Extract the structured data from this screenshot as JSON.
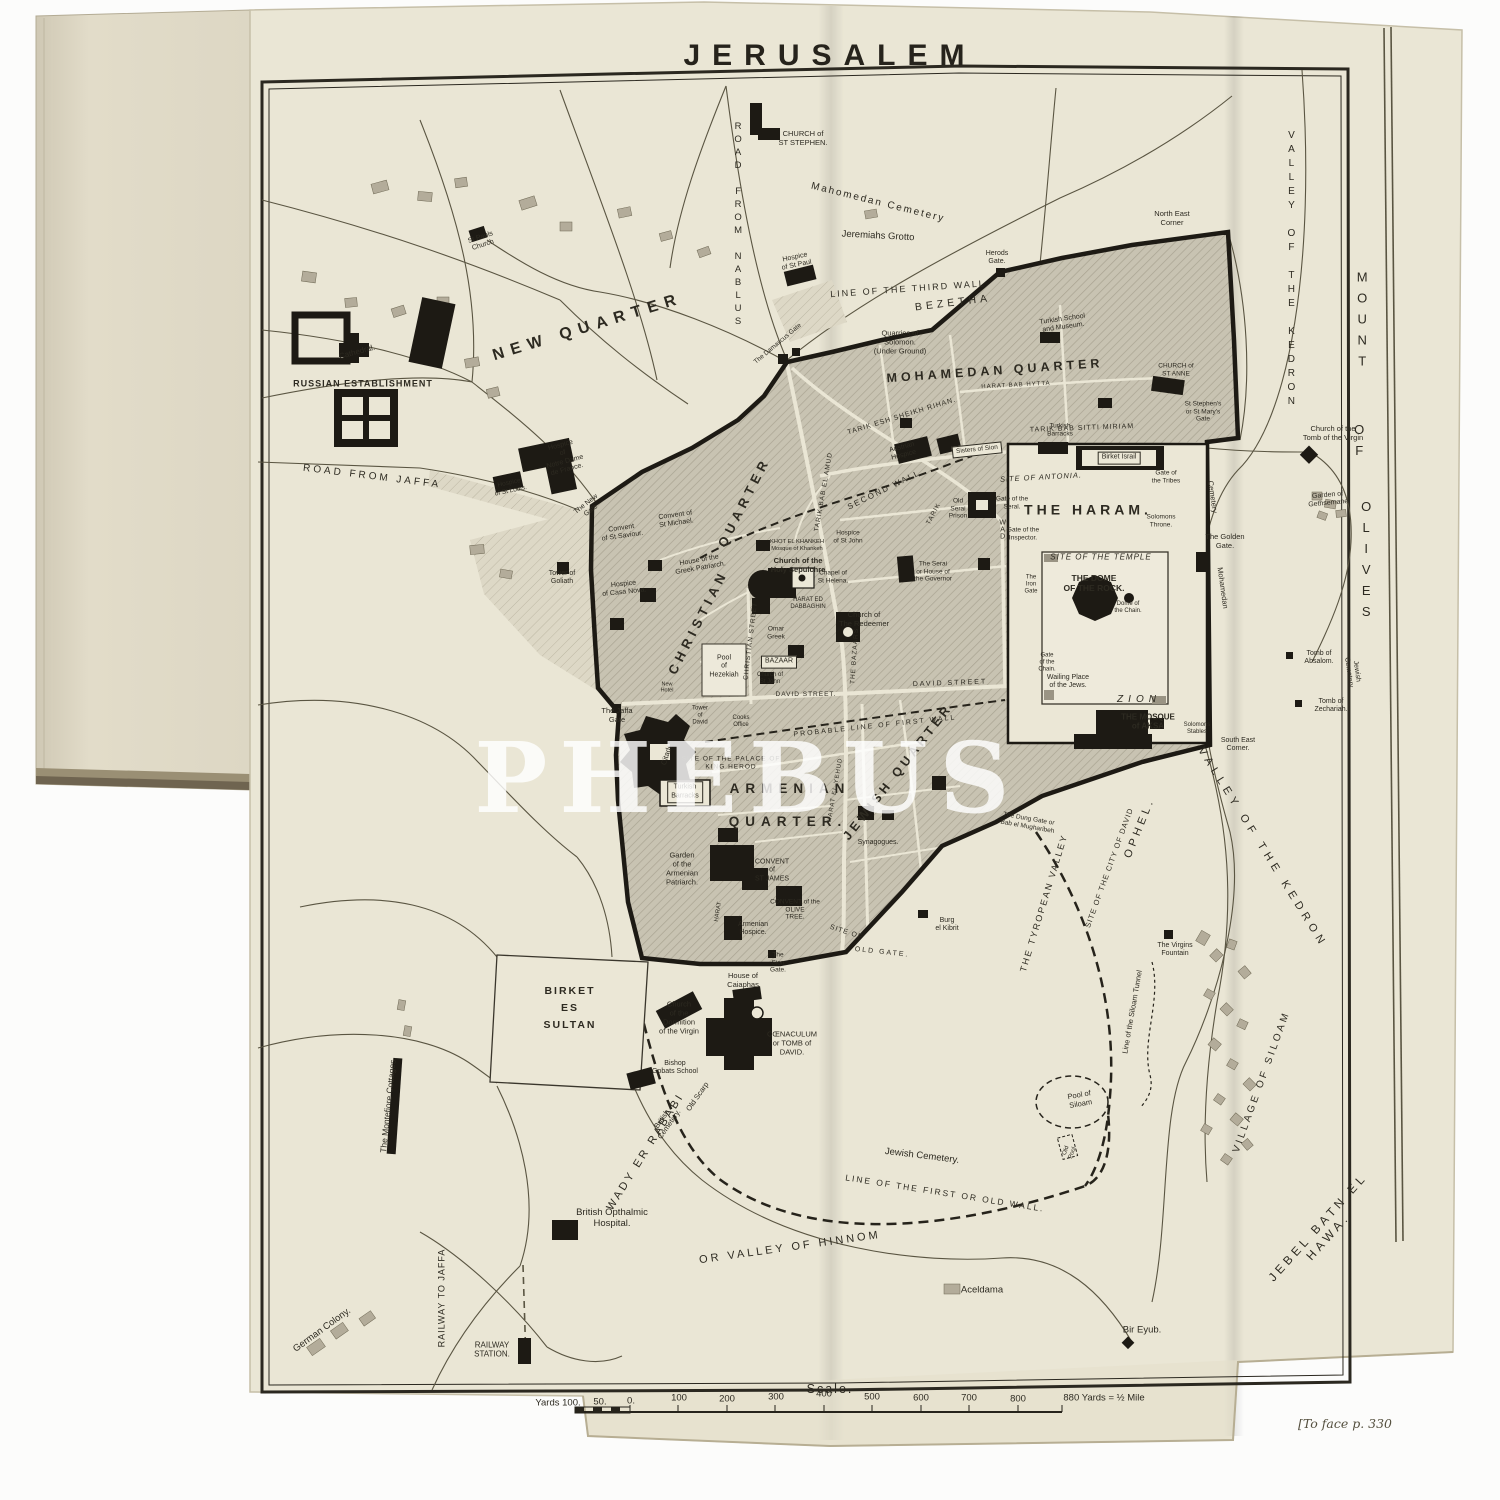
{
  "page": {
    "title": "JERUSALEM",
    "watermark": "PHEBUS",
    "caption": "[To face p. 330"
  },
  "scale": {
    "heading": "— Scale. —"
  },
  "labels": [
    {
      "t": "NEW QUARTER",
      "x": 588,
      "y": 328,
      "r": -17,
      "s": 16,
      "ls": 7,
      "c": "b"
    },
    {
      "t": "MOHAMEDAN QUARTER",
      "x": 995,
      "y": 371,
      "r": -4,
      "s": 12.5,
      "ls": 4,
      "c": "b"
    },
    {
      "t": "CHRISTIAN",
      "x": 698,
      "y": 622,
      "r": -63,
      "s": 13,
      "ls": 5,
      "c": "b"
    },
    {
      "t": "QUARTER",
      "x": 744,
      "y": 502,
      "r": -63,
      "s": 13,
      "ls": 5,
      "c": "b"
    },
    {
      "t": "ARMENIAN",
      "x": 790,
      "y": 789,
      "s": 13.5,
      "ls": 6,
      "c": "b"
    },
    {
      "t": "QUARTER.",
      "x": 788,
      "y": 822,
      "s": 13.5,
      "ls": 6,
      "c": "b"
    },
    {
      "t": "JEWISH QUARTER",
      "x": 898,
      "y": 772,
      "r": -52,
      "s": 12.5,
      "ls": 4,
      "c": "b"
    },
    {
      "t": "THE HARAM.",
      "x": 1088,
      "y": 510,
      "s": 14,
      "ls": 4,
      "c": "b"
    },
    {
      "t": "BEZETHA",
      "x": 953,
      "y": 303,
      "r": -7,
      "s": 10.5,
      "ls": 4
    },
    {
      "t": "ZION",
      "x": 1139,
      "y": 700,
      "s": 10,
      "ls": 5,
      "c": "i"
    },
    {
      "t": "RUSSIAN ESTABLISHMENT",
      "x": 363,
      "y": 384,
      "s": 9,
      "ls": 1,
      "c": "b"
    },
    {
      "t": "BIRKET\nES\nSULTAN",
      "x": 570,
      "y": 1008,
      "s": 10.5,
      "ls": 2,
      "c": "b lh"
    },
    {
      "t": "MOUNT",
      "x": 1362,
      "y": 322,
      "s": 13,
      "ls": 6,
      "c": "stack"
    },
    {
      "t": "OF",
      "x": 1359,
      "y": 443,
      "s": 13,
      "ls": 6,
      "c": "stack"
    },
    {
      "t": "OLIVES",
      "x": 1366,
      "y": 562,
      "s": 13,
      "ls": 6,
      "c": "stack"
    },
    {
      "t": "VALLEY OF THE KEDRON",
      "x": 1291,
      "y": 270,
      "s": 10,
      "ls": 3,
      "c": "stack"
    },
    {
      "t": "VALLEY OF THE KEDRON",
      "x": 1262,
      "y": 848,
      "r": 58,
      "s": 11,
      "ls": 5
    },
    {
      "t": "OPHEL.",
      "x": 1140,
      "y": 828,
      "r": -68,
      "s": 11,
      "ls": 4
    },
    {
      "t": "THE TYROPEAN VALLEY",
      "x": 1044,
      "y": 903,
      "r": -73,
      "s": 9,
      "ls": 2
    },
    {
      "t": "SITE OF THE CITY OF DAVID",
      "x": 1110,
      "y": 868,
      "r": -70,
      "s": 7.5,
      "ls": 1
    },
    {
      "t": "Line of the Siloam Tunnel",
      "x": 1133,
      "y": 1012,
      "r": -80,
      "s": 7.5
    },
    {
      "t": "VILLAGE OF SILOAM",
      "x": 1262,
      "y": 1082,
      "r": -70,
      "s": 10,
      "ls": 3
    },
    {
      "t": "JEBEL BATN EL HAWA.",
      "x": 1323,
      "y": 1232,
      "r": -48,
      "s": 12,
      "ls": 4
    },
    {
      "t": "WADY ER RABABI",
      "x": 646,
      "y": 1152,
      "r": -58,
      "s": 11,
      "ls": 3
    },
    {
      "t": "OR VALLEY OF HINNOM",
      "x": 790,
      "y": 1248,
      "r": -8,
      "s": 11,
      "ls": 3
    },
    {
      "t": "LINE OF THE FIRST OR OLD WALL.",
      "x": 945,
      "y": 1193,
      "r": 9,
      "s": 8.5,
      "ls": 2
    },
    {
      "t": "Jewish Cemetery.",
      "x": 922,
      "y": 1156,
      "r": 7,
      "s": 9.5
    },
    {
      "t": "Mahomedan Cemetery",
      "x": 878,
      "y": 203,
      "r": 14,
      "s": 10,
      "ls": 2
    },
    {
      "t": "Jeremiahs Grotto",
      "x": 878,
      "y": 236,
      "r": 3,
      "s": 9.5
    },
    {
      "t": "LINE OF THE THIRD WALL",
      "x": 908,
      "y": 289,
      "r": -4,
      "s": 9,
      "ls": 2
    },
    {
      "t": "Herods\nGate.",
      "x": 997,
      "y": 258,
      "s": 7
    },
    {
      "t": "North East\nCorner",
      "x": 1172,
      "y": 219,
      "s": 7.5
    },
    {
      "t": "ROAD FROM NABLUS",
      "x": 738,
      "y": 225,
      "s": 9.5,
      "ls": 2,
      "c": "stack"
    },
    {
      "t": "ROAD FROM JAFFA",
      "x": 372,
      "y": 477,
      "r": 7,
      "s": 10,
      "ls": 3
    },
    {
      "t": "RAILWAY TO JAFFA",
      "x": 442,
      "y": 1298,
      "r": -90,
      "s": 9,
      "ls": 1
    },
    {
      "t": "RAILWAY\nSTATION.",
      "x": 492,
      "y": 1350,
      "s": 8
    },
    {
      "t": "German Colony.",
      "x": 322,
      "y": 1330,
      "r": -36,
      "s": 9.5
    },
    {
      "t": "The Montefiore Cottages.",
      "x": 388,
      "y": 1105,
      "r": -84,
      "s": 8.5
    },
    {
      "t": "British Opthalmic\nHospital.",
      "x": 612,
      "y": 1218,
      "s": 9.5
    },
    {
      "t": "Aceldama",
      "x": 982,
      "y": 1290,
      "s": 9.5
    },
    {
      "t": "Bir Eyub.",
      "x": 1142,
      "y": 1330,
      "s": 9.5
    },
    {
      "t": "St Pauls\nChurch",
      "x": 482,
      "y": 242,
      "r": -18,
      "s": 7
    },
    {
      "t": "Cathedral.",
      "x": 357,
      "y": 352,
      "r": -15,
      "s": 8
    },
    {
      "t": "CHURCH of\nST STEPHEN.",
      "x": 803,
      "y": 139,
      "s": 7.5
    },
    {
      "t": "Hospice\nof St Paul",
      "x": 796,
      "y": 262,
      "r": -12,
      "s": 7
    },
    {
      "t": "Hospice\nof\nNotre Dame\nde France.",
      "x": 564,
      "y": 458,
      "r": -15,
      "s": 7
    },
    {
      "t": "Hospice\nof St Louis.",
      "x": 510,
      "y": 487,
      "r": -12,
      "s": 6.5
    },
    {
      "t": "Convent\nof St Saviour.",
      "x": 622,
      "y": 533,
      "r": -8,
      "s": 7
    },
    {
      "t": "Convent of\nSt Michael.",
      "x": 676,
      "y": 520,
      "r": -8,
      "s": 7
    },
    {
      "t": "The New\nGate",
      "x": 589,
      "y": 508,
      "r": -38,
      "s": 7
    },
    {
      "t": "Tower of\nGoliath",
      "x": 562,
      "y": 578,
      "s": 7
    },
    {
      "t": "Hospice\nof Casa Nova.",
      "x": 624,
      "y": 589,
      "r": -6,
      "s": 7
    },
    {
      "t": "House of the\nGreek Patriarch.",
      "x": 700,
      "y": 565,
      "r": -10,
      "s": 7
    },
    {
      "t": "KHOT EL KHANKEH\nMosque of Khankeh",
      "x": 797,
      "y": 546,
      "s": 5.8
    },
    {
      "t": "Church of the\nHoly Sepulchre",
      "x": 798,
      "y": 566,
      "s": 7.5,
      "c": "b"
    },
    {
      "t": "Chapel of\nSt Helena.",
      "x": 833,
      "y": 577,
      "s": 6.5
    },
    {
      "t": "HARAT ED\nDABBAGHIN",
      "x": 808,
      "y": 604,
      "s": 6
    },
    {
      "t": "Church of\nThe Redeemer",
      "x": 864,
      "y": 620,
      "s": 7.5
    },
    {
      "t": "Hospice\nof St John",
      "x": 848,
      "y": 537,
      "s": 6.5
    },
    {
      "t": "Omar\nGreek",
      "x": 776,
      "y": 633,
      "s": 6.5
    },
    {
      "t": "BAZAAR",
      "x": 779,
      "y": 662,
      "s": 7,
      "c": "box"
    },
    {
      "t": "Pool\nof\nHezekiah",
      "x": 724,
      "y": 667,
      "s": 7
    },
    {
      "t": "Church of\nSt John",
      "x": 770,
      "y": 679,
      "s": 6
    },
    {
      "t": "DAVID STREET.",
      "x": 806,
      "y": 695,
      "s": 6.5,
      "ls": 1
    },
    {
      "t": "DAVID STREET",
      "x": 950,
      "y": 684,
      "r": -2,
      "s": 7,
      "ls": 2
    },
    {
      "t": "CHRISTIAN STREET",
      "x": 751,
      "y": 641,
      "r": -83,
      "s": 6.5,
      "ls": 1
    },
    {
      "t": "THE BAZAARS",
      "x": 855,
      "y": 656,
      "r": -86,
      "s": 6.5,
      "ls": 1
    },
    {
      "t": "SECOND WALL",
      "x": 884,
      "y": 490,
      "r": -26,
      "s": 8,
      "ls": 2
    },
    {
      "t": "TARIK BAB EL AMUD",
      "x": 824,
      "y": 492,
      "r": -80,
      "s": 6.5,
      "ls": 1
    },
    {
      "t": "TARIK ESH SHEIKH RIHAN.",
      "x": 902,
      "y": 417,
      "r": -17,
      "s": 7,
      "ls": 1
    },
    {
      "t": "TARIK BAB SITTI MIRIAM",
      "x": 1082,
      "y": 429,
      "r": -2,
      "s": 7,
      "ls": 1
    },
    {
      "t": "Austrian\nHospice",
      "x": 903,
      "y": 452,
      "r": -14,
      "s": 7
    },
    {
      "t": "Sisters of Sion",
      "x": 977,
      "y": 450,
      "r": -6,
      "s": 6.5,
      "c": "box"
    },
    {
      "t": "Old\nSerai\nPrison",
      "x": 958,
      "y": 509,
      "s": 6.5
    },
    {
      "t": "The Serai\nor House of\nthe Governor",
      "x": 933,
      "y": 572,
      "s": 6.5
    },
    {
      "t": "SITE OF ANTONIA.",
      "x": 1041,
      "y": 478,
      "r": -3,
      "s": 7.5,
      "ls": 1,
      "c": "i"
    },
    {
      "t": "Gate of the\nSeral.",
      "x": 1012,
      "y": 503,
      "s": 6.5
    },
    {
      "t": "Gate of the\nInspector.",
      "x": 1023,
      "y": 534,
      "s": 6.5
    },
    {
      "t": "HARAT BAB HYTTA",
      "x": 1016,
      "y": 386,
      "r": -3,
      "s": 6,
      "ls": 1
    },
    {
      "t": "Turkish School\nand Museum.",
      "x": 1063,
      "y": 324,
      "r": -8,
      "s": 7
    },
    {
      "t": "Quarries of\nSolomon.\n(Under Ground)",
      "x": 900,
      "y": 343,
      "s": 7.5
    },
    {
      "t": "The Damascus Gate",
      "x": 778,
      "y": 344,
      "r": -40,
      "s": 6.5
    },
    {
      "t": "CHURCH of\nST ANNE",
      "x": 1176,
      "y": 370,
      "s": 6.5
    },
    {
      "t": "St Stephen's\nor St Mary's\nGate",
      "x": 1203,
      "y": 412,
      "s": 6.5
    },
    {
      "t": "Birket Israil",
      "x": 1119,
      "y": 458,
      "s": 7,
      "c": "box"
    },
    {
      "t": "Gate of\nthe Tribes",
      "x": 1166,
      "y": 477,
      "s": 6.5
    },
    {
      "t": "Turkish\nBarracks",
      "x": 1060,
      "y": 430,
      "s": 6.5
    },
    {
      "t": "WAD",
      "x": 1002,
      "y": 530,
      "s": 7,
      "c": "stack"
    },
    {
      "t": "TARIK",
      "x": 934,
      "y": 514,
      "r": -62,
      "s": 6.5,
      "ls": 1
    },
    {
      "t": "SITE OF THE TEMPLE",
      "x": 1101,
      "y": 557,
      "s": 8,
      "ls": 1,
      "c": "i"
    },
    {
      "t": "THE DOME\nOF THE ROCK.",
      "x": 1094,
      "y": 583,
      "s": 8.5,
      "c": "b"
    },
    {
      "t": "Dome of\nthe Chain.",
      "x": 1128,
      "y": 608,
      "s": 6
    },
    {
      "t": "The\nIron\nGate",
      "x": 1031,
      "y": 585,
      "s": 6
    },
    {
      "t": "Gate\nof the\nChain.",
      "x": 1047,
      "y": 663,
      "s": 6
    },
    {
      "t": "Wailing Place\nof the Jews.",
      "x": 1068,
      "y": 682,
      "s": 7
    },
    {
      "t": "Solomons\nThrone.",
      "x": 1161,
      "y": 521,
      "s": 6.5
    },
    {
      "t": "The Golden\nGate.",
      "x": 1225,
      "y": 542,
      "s": 7.5
    },
    {
      "t": "Cemetery",
      "x": 1212,
      "y": 497,
      "r": 82,
      "s": 7.5
    },
    {
      "t": "Mohamedan",
      "x": 1222,
      "y": 588,
      "r": 82,
      "s": 7.5
    },
    {
      "t": "THE MOSQUE\nof AKSA",
      "x": 1148,
      "y": 722,
      "s": 8,
      "c": "b"
    },
    {
      "t": "Solomons\nStables",
      "x": 1197,
      "y": 729,
      "s": 6
    },
    {
      "t": "South East\nCorner.",
      "x": 1238,
      "y": 745,
      "s": 7
    },
    {
      "t": "Tomb of\nAbsalom.",
      "x": 1319,
      "y": 658,
      "s": 7
    },
    {
      "t": "Tomb of\nZechariah.",
      "x": 1331,
      "y": 706,
      "s": 7
    },
    {
      "t": "Jewish\nCemetery",
      "x": 1352,
      "y": 672,
      "r": 82,
      "s": 7
    },
    {
      "t": "Church of the\nTomb of the Virgin",
      "x": 1333,
      "y": 434,
      "s": 7.5
    },
    {
      "t": "Garden of\nGethsemane",
      "x": 1328,
      "y": 500,
      "r": -5,
      "s": 7
    },
    {
      "t": "PROBABLE LINE OF FIRST WALL",
      "x": 875,
      "y": 727,
      "r": -6,
      "s": 7,
      "ls": 2
    },
    {
      "t": "The Jaffa\nGate",
      "x": 617,
      "y": 716,
      "s": 7.5
    },
    {
      "t": "Tower\nof\nDavid",
      "x": 700,
      "y": 716,
      "s": 6
    },
    {
      "t": "Cooks\nOffice",
      "x": 741,
      "y": 722,
      "s": 6
    },
    {
      "t": "Citadel.",
      "x": 668,
      "y": 753,
      "r": -72,
      "s": 7.5
    },
    {
      "t": "SITE OF THE PALACE OF\nKING HEROD",
      "x": 731,
      "y": 763,
      "s": 6.5,
      "ls": 1
    },
    {
      "t": "Turkish\nBarracks",
      "x": 685,
      "y": 792,
      "s": 7,
      "c": "box"
    },
    {
      "t": "Garden\nof the\nArmenian\nPatriarch.",
      "x": 682,
      "y": 869,
      "s": 7.5
    },
    {
      "t": "CONVENT\nof\nST JAMES",
      "x": 772,
      "y": 871,
      "s": 7
    },
    {
      "t": "CONVENT of the\nOLIVE\nTREE.",
      "x": 795,
      "y": 910,
      "s": 6.5
    },
    {
      "t": "Armenian\nHospice.",
      "x": 753,
      "y": 929,
      "s": 7
    },
    {
      "t": "Synagogues.",
      "x": 878,
      "y": 843,
      "s": 7
    },
    {
      "t": "HARAT EL YEHUD",
      "x": 836,
      "y": 790,
      "r": -80,
      "s": 6,
      "ls": 1
    },
    {
      "t": "HARAT",
      "x": 719,
      "y": 912,
      "r": -80,
      "s": 6
    },
    {
      "t": "The Dung Gate or\nBab el Mugharibeh",
      "x": 1028,
      "y": 823,
      "r": 10,
      "s": 6.5
    },
    {
      "t": "Burg\nel Kibrit",
      "x": 947,
      "y": 925,
      "s": 7
    },
    {
      "t": "SITE OF",
      "x": 846,
      "y": 933,
      "r": 18,
      "s": 7,
      "ls": 1
    },
    {
      "t": "OLD GATE.",
      "x": 882,
      "y": 953,
      "r": 6,
      "s": 7,
      "ls": 2
    },
    {
      "t": "The\nSion\nGate.",
      "x": 778,
      "y": 963,
      "s": 6.5
    },
    {
      "t": "House of\nCaiaphas",
      "x": 743,
      "y": 981,
      "s": 7.5
    },
    {
      "t": "Church\nof the\nDormition\nof the Virgin",
      "x": 679,
      "y": 1018,
      "s": 7.5
    },
    {
      "t": "CŒNACULUM\nor TOMB of\nDAVID.",
      "x": 792,
      "y": 1044,
      "s": 7.5
    },
    {
      "t": "Bishop\nGobats School",
      "x": 675,
      "y": 1068,
      "s": 7
    },
    {
      "t": "Old Scarp",
      "x": 698,
      "y": 1097,
      "r": -55,
      "s": 7.5
    },
    {
      "t": "British\nCemetery.",
      "x": 666,
      "y": 1122,
      "r": -55,
      "s": 7.5
    },
    {
      "t": "The Virgins\nFountain",
      "x": 1175,
      "y": 950,
      "s": 7
    },
    {
      "t": "Pool of\nSiloam",
      "x": 1080,
      "y": 1100,
      "r": -10,
      "s": 7.5
    },
    {
      "t": "Old\nPool",
      "x": 1070,
      "y": 1152,
      "r": -70,
      "s": 6
    },
    {
      "t": "New\nHotel",
      "x": 667,
      "y": 688,
      "s": 5.5
    },
    {
      "t": "Yards 100.",
      "x": 558,
      "y": 1403,
      "s": 9.5
    },
    {
      "t": "50.",
      "x": 600,
      "y": 1402,
      "s": 9.5
    },
    {
      "t": "0.",
      "x": 631,
      "y": 1401,
      "s": 9.5
    },
    {
      "t": "100",
      "x": 679,
      "y": 1398,
      "s": 9.5
    },
    {
      "t": "200",
      "x": 727,
      "y": 1399,
      "s": 9.5
    },
    {
      "t": "300",
      "x": 776,
      "y": 1397,
      "s": 9.5
    },
    {
      "t": "400",
      "x": 824,
      "y": 1394,
      "s": 9.5
    },
    {
      "t": "500",
      "x": 872,
      "y": 1397,
      "s": 9.5
    },
    {
      "t": "600",
      "x": 921,
      "y": 1398,
      "s": 9.5
    },
    {
      "t": "700",
      "x": 969,
      "y": 1398,
      "s": 9.5
    },
    {
      "t": "800",
      "x": 1018,
      "y": 1399,
      "s": 9.5
    },
    {
      "t": "880 Yards = ½ Mile",
      "x": 1104,
      "y": 1398,
      "s": 9.5
    }
  ]
}
